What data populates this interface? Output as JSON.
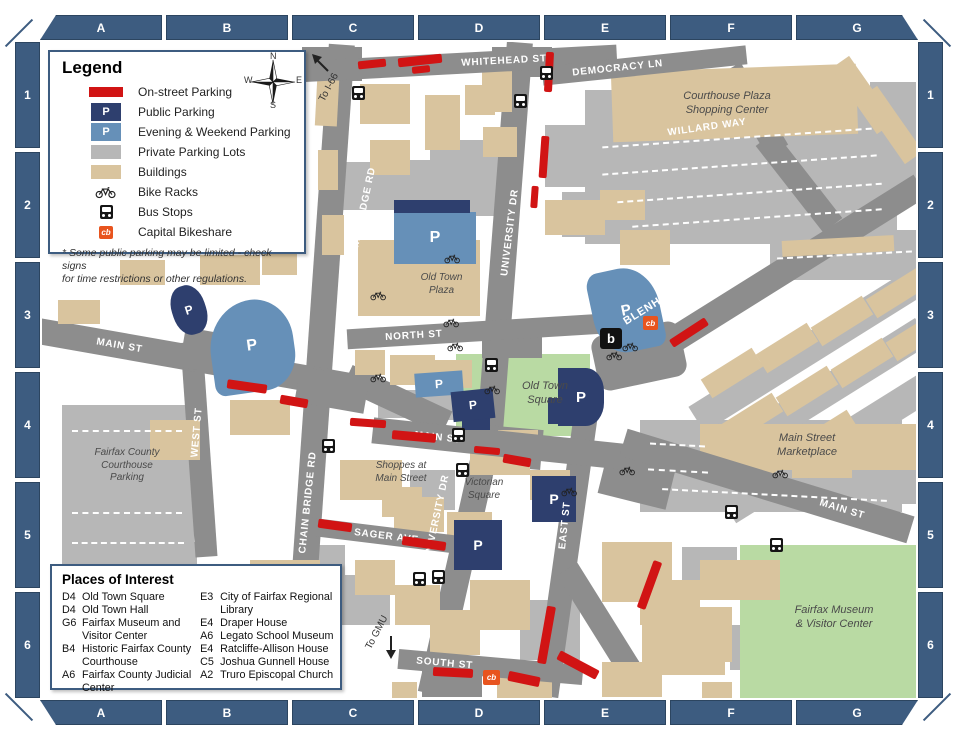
{
  "grid": {
    "cols": [
      "A",
      "B",
      "C",
      "D",
      "E",
      "F",
      "G"
    ],
    "rows": [
      "1",
      "2",
      "3",
      "4",
      "5",
      "6"
    ]
  },
  "compass": {
    "n": "N",
    "e": "E",
    "s": "S",
    "w": "W"
  },
  "legend": {
    "title": "Legend",
    "items": [
      {
        "label": "On-street Parking"
      },
      {
        "label": "Public Parking"
      },
      {
        "label": "Evening & Weekend Parking"
      },
      {
        "label": "Private Parking Lots"
      },
      {
        "label": "Buildings"
      },
      {
        "label": "Bike Racks"
      },
      {
        "label": "Bus Stops"
      },
      {
        "label": "Capital Bikeshare"
      }
    ],
    "note": "* Some public parking may be limited - check signs\nfor time restrictions or other regulations."
  },
  "places_of_interest": {
    "title": "Places of Interest",
    "column1": [
      {
        "code": "D4",
        "name": "Old Town Square"
      },
      {
        "code": "D4",
        "name": "Old Town Hall"
      },
      {
        "code": "G6",
        "name": "Fairfax Museum and Visitor Center"
      },
      {
        "code": "B4",
        "name": "Historic Fairfax County Courthouse"
      },
      {
        "code": "A6",
        "name": "Fairfax County Judicial Center"
      }
    ],
    "column2": [
      {
        "code": "E3",
        "name": "City of Fairfax Regional Library"
      },
      {
        "code": "E4",
        "name": "Draper House"
      },
      {
        "code": "A6",
        "name": "Legato School Museum"
      },
      {
        "code": "E4",
        "name": "Ratcliffe-Allison House"
      },
      {
        "code": "C5",
        "name": "Joshua Gunnell House"
      },
      {
        "code": "A2",
        "name": "Truro Episcopal Church"
      }
    ]
  },
  "streets": {
    "whitehead": "WHITEHEAD ST",
    "democracy": "DEMOCRACY LN",
    "willard": "WILLARD WAY",
    "chain_bridge": "CHAIN BRIDGE RD",
    "university": "UNIVERSITY DR",
    "blenheim": "BLENHEIM BLVD",
    "main": "MAIN ST",
    "north": "NORTH ST",
    "west": "WEST ST",
    "east": "EAST ST",
    "sager": "SAGER AVE",
    "south": "SOUTH ST"
  },
  "map_labels": {
    "courthouse_plaza": "Courthouse Plaza\nShopping Center",
    "old_town_plaza": "Old Town\nPlaza",
    "old_town_square": "Old Town\nSquare",
    "marketplace": "Main Street\nMarketplace",
    "courthouse_parking": "Fairfax County\nCourthouse\nParking",
    "shoppes": "Shoppes at\nMain Street",
    "victorian": "Victorian\nSquare",
    "museum": "Fairfax Museum\n& Visitor Center"
  },
  "directions": {
    "to_i66": "To I-66",
    "to_gmu": "To GMU"
  },
  "markers": {
    "p": "P",
    "cb": "cb",
    "bikeshare_station": "b"
  },
  "colors": {
    "frame": "#3d5c80",
    "road": "#8d8d8d",
    "building": "#d9c49e",
    "private_lot": "#b7b7b7",
    "public_parking": "#2e3f6e",
    "evening_weekend_parking": "#6690b8",
    "on_street": "#d11414",
    "green": "#b9daa3",
    "bikeshare_orange": "#e8541e"
  }
}
